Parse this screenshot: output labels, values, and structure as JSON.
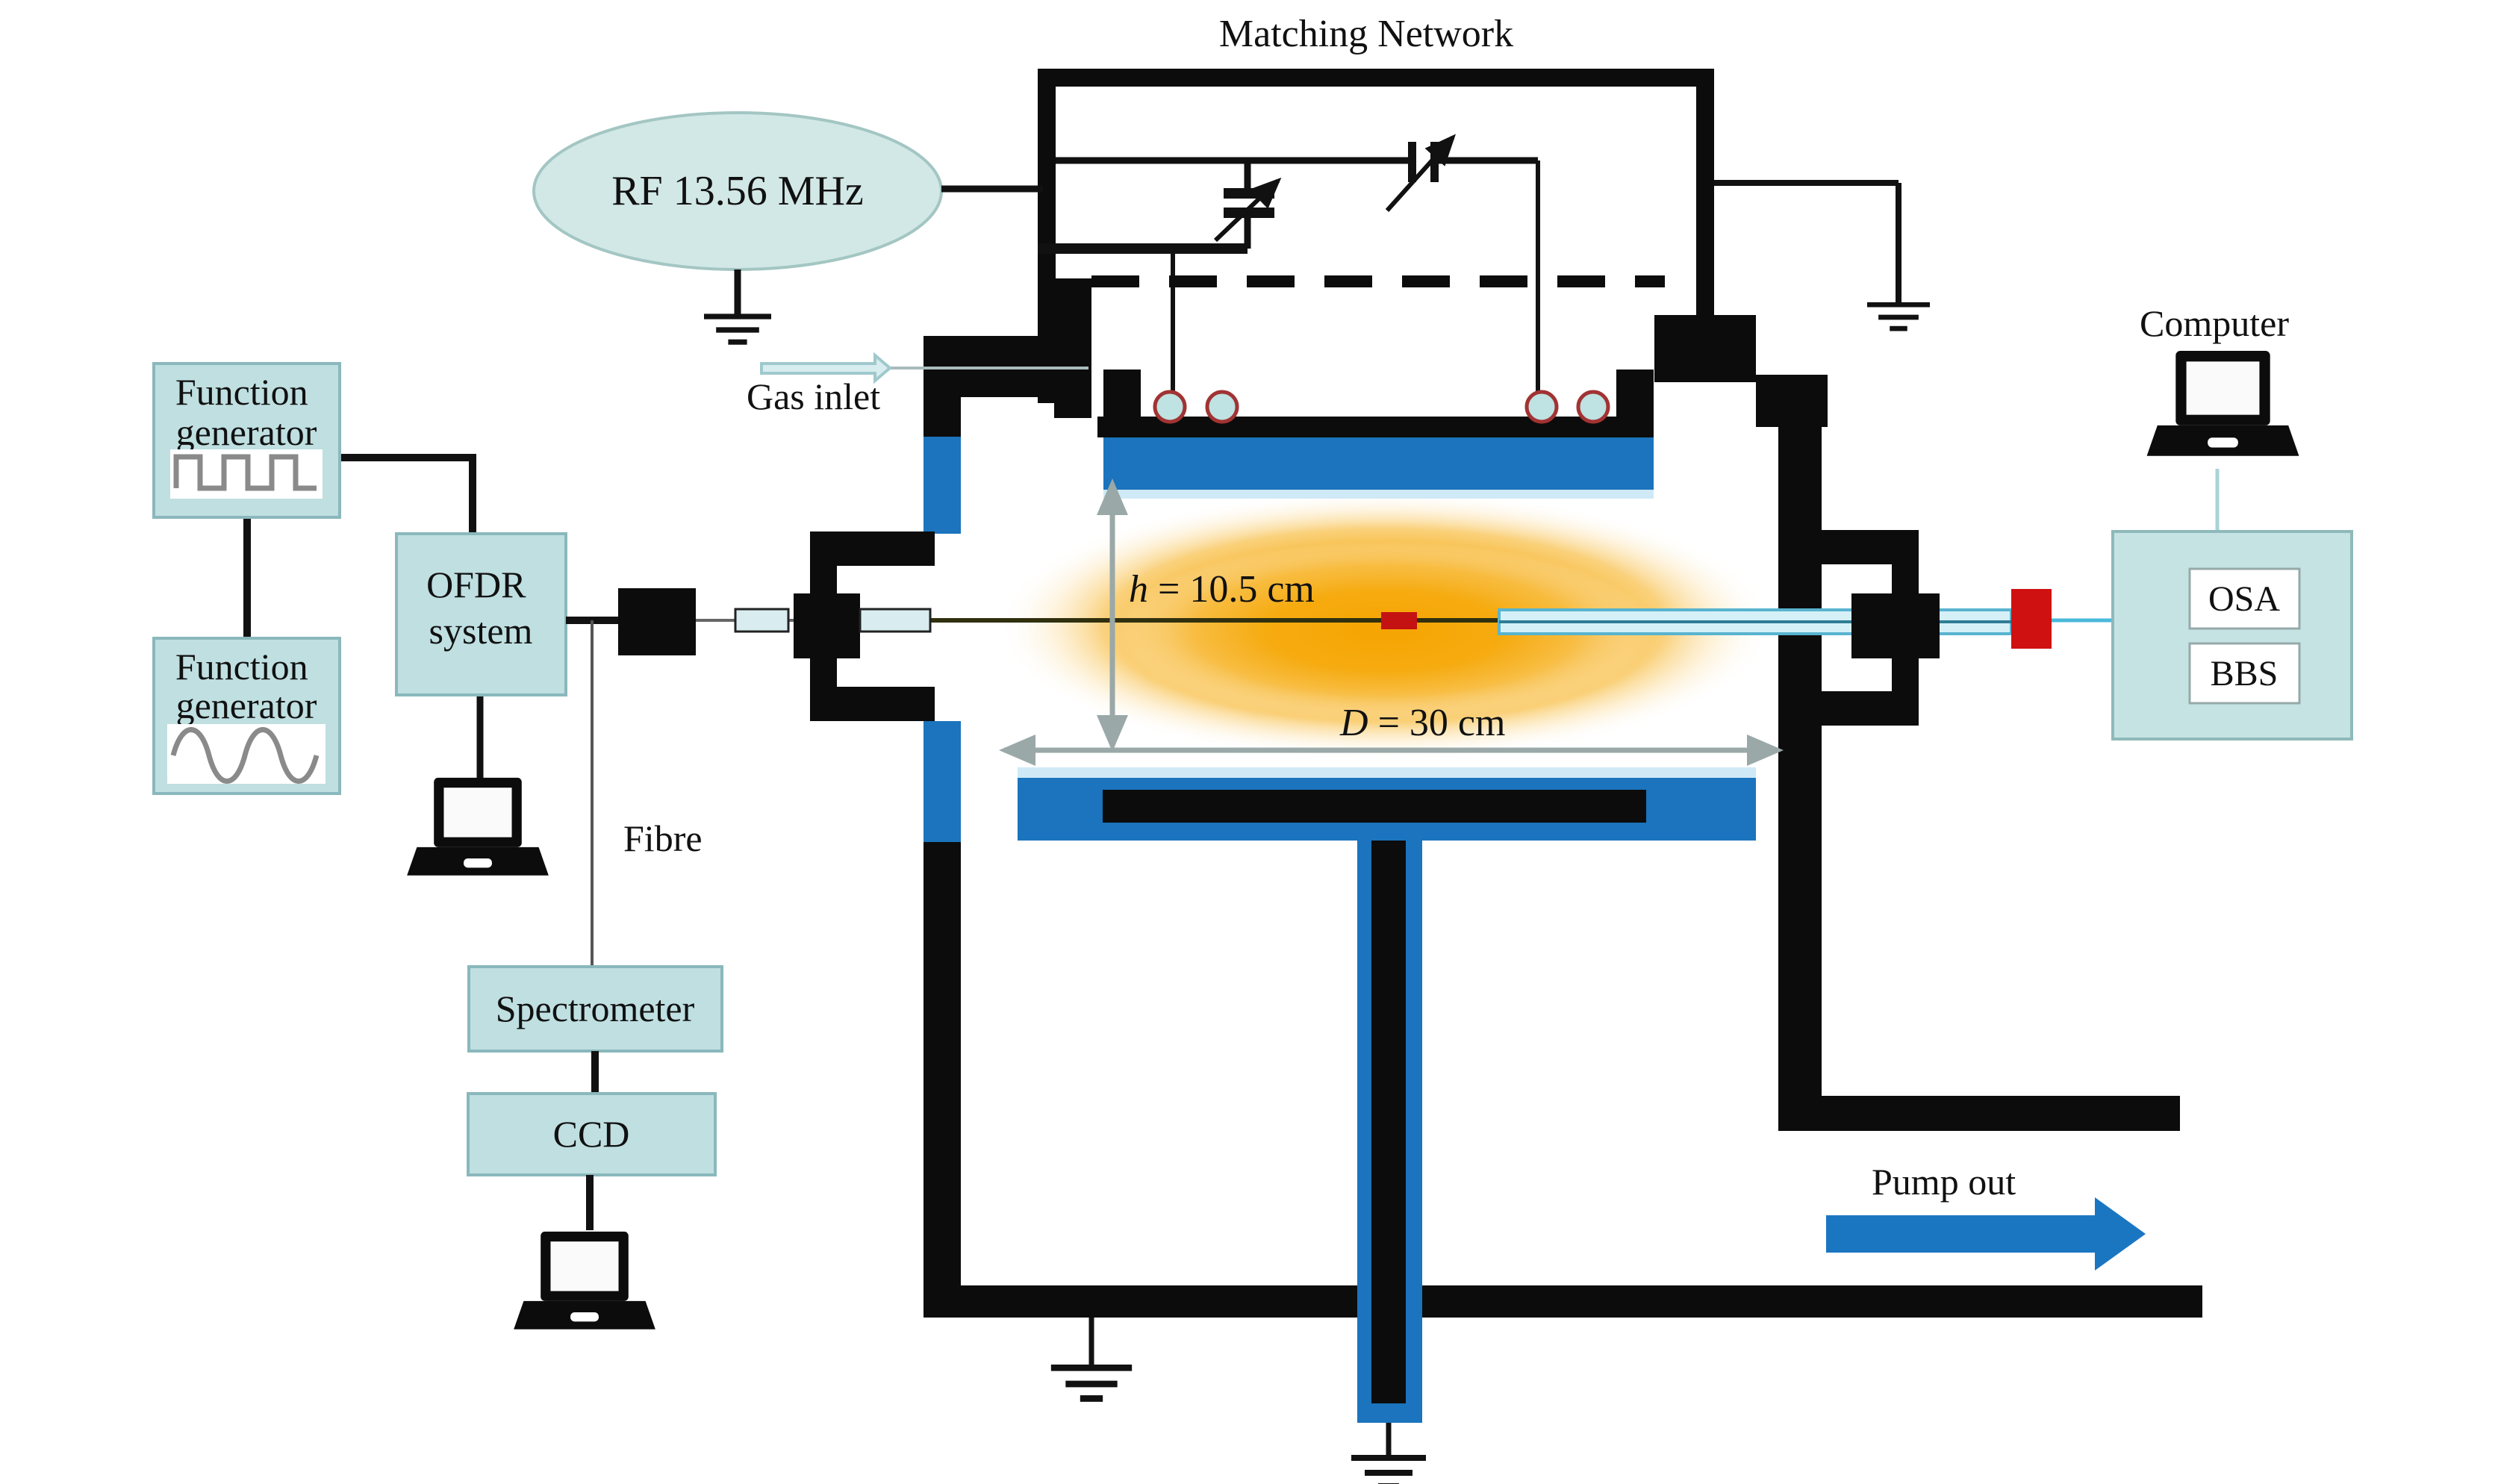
{
  "labels": {
    "matching_network": "Matching Network",
    "rf_source": "RF 13.56 MHz",
    "gas_inlet": "Gas inlet",
    "fibre": "Fibre",
    "pump_out": "Pump out",
    "computer": "Computer",
    "h_var": "h",
    "h_rest": " = 10.5 cm",
    "d_var": "D",
    "d_rest": " = 30 cm"
  },
  "boxes": {
    "function_generator_1": {
      "line1": "Function",
      "line2": "generator"
    },
    "function_generator_2": {
      "line1": "Function",
      "line2": "generator"
    },
    "ofdr": {
      "line1": "OFDR",
      "line2": "system"
    },
    "spectrometer": {
      "label": "Spectrometer"
    },
    "ccd": {
      "label": "CCD"
    },
    "osa": {
      "label": "OSA"
    },
    "bbs": {
      "label": "BBS"
    }
  },
  "icons": [
    "laptop-icon",
    "ground-icon",
    "square-wave-icon",
    "sine-wave-icon",
    "variable-capacitor-icon",
    "gas-inlet-arrow-icon",
    "pump-out-arrow-icon",
    "plasma-glow",
    "fbg-sensor",
    "fibre-splitter-dot-icon",
    "dimension-arrow-icon",
    "electrode-insulator-icon"
  ],
  "colors": {
    "panel_fill": "#bfdfe1",
    "panel_border": "#8ab8bc",
    "rf_ellipse_fill": "#d2e8e6",
    "chamber_blue": "#1b74bd",
    "plasma_core": "#f5a502",
    "pump_arrow_blue": "#1b76c2",
    "fbg_red": "#c41111",
    "dimension_arrow_gray": "#9aa8a8",
    "fibre_teal": "#49b9da",
    "capillary_fill": "#d6f0f8",
    "waveform_gray": "#8a8a8a"
  }
}
